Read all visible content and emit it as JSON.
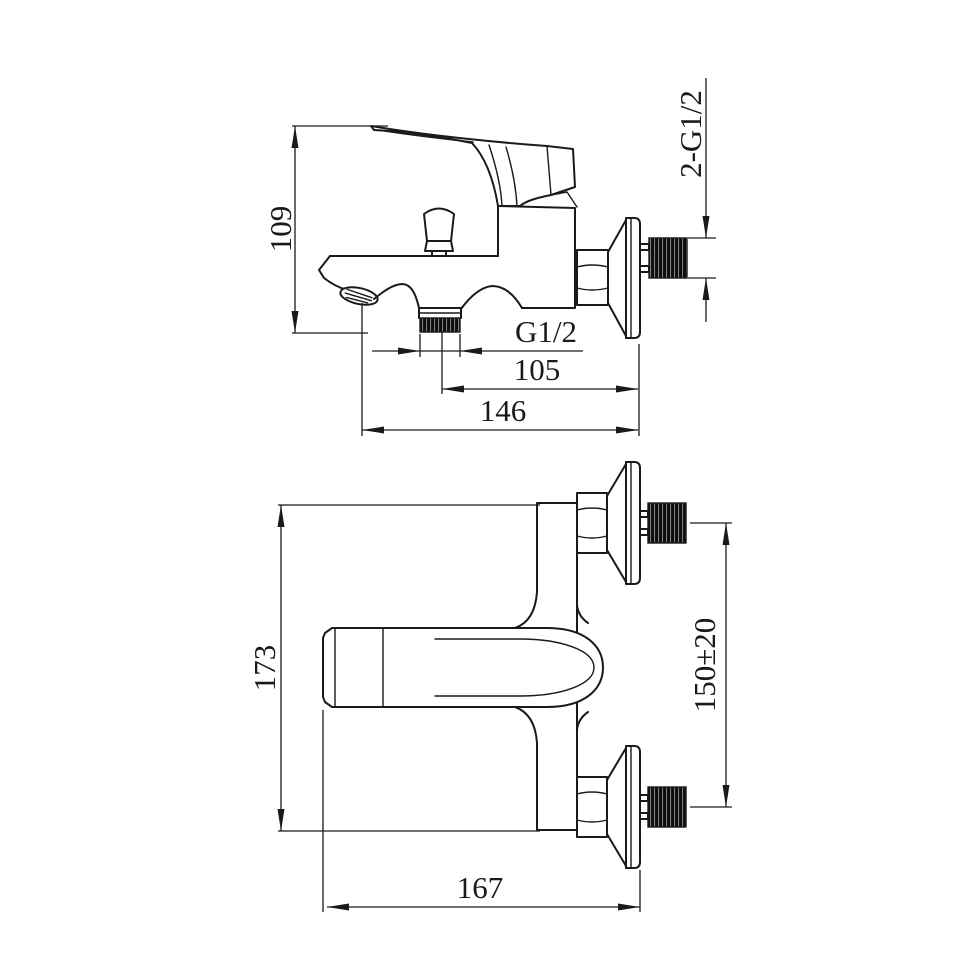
{
  "colors": {
    "background": "#ffffff",
    "line": "#1a1a1a",
    "thread_fill": "#0e0e0e"
  },
  "dimensions": {
    "side_view": {
      "overall_height": "109",
      "outlet_thread": "G1/2",
      "outlet_to_wall": "105",
      "spout_to_wall": "146",
      "wall_threads": "2-G1/2"
    },
    "plan_view": {
      "overall_height": "173",
      "inlet_spacing": "150±20",
      "overall_length": "167"
    }
  }
}
